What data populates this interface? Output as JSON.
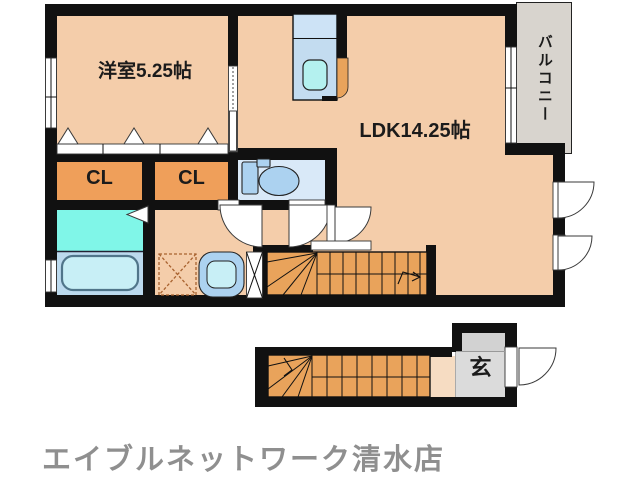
{
  "plan": {
    "upper_floor": {
      "rooms": {
        "western": "洋室5.25帖",
        "ldk": "LDK14.25帖",
        "balcony": "バルコニー",
        "closet1": "CL",
        "closet2": "CL"
      },
      "fixtures": [
        "kitchen-sink-icon",
        "toilet-icon",
        "bathtub-icon",
        "vanity-sink-icon",
        "washing-machine-pan-icon",
        "staircase-up-icon",
        "folding-closet-door-icon",
        "sliding-door-icon",
        "door-swing-icon",
        "window-icon",
        "accordion-door-icon"
      ]
    },
    "lower_floor": {
      "rooms": {
        "entrance": "玄"
      },
      "fixtures": [
        "staircase-up-icon",
        "entrance-door-swing-icon"
      ]
    }
  },
  "footer": {
    "brand": "エイブルネットワーク清水店"
  },
  "colors": {
    "wall": "#111111",
    "floor": "#F4CDAA",
    "floor-light": "#F6DCC2",
    "closet": "#EF9F5A",
    "stairs": "#E9A35B",
    "washroom": "#80F6E8",
    "bath": "#BCDAEE",
    "toilet-room": "#D9E9F8",
    "fixture": "#ACD2F0",
    "tub": "#C8EFF6",
    "kitchen": "#C3DCF0",
    "kitchen-light": "#CDE3F6",
    "sink": "#B4F1EF",
    "balcony": "#D8D4CE",
    "entry": "#DBDBDB",
    "entry-dark": "#D2D2D2",
    "brand-text": "#8F8F8F"
  }
}
